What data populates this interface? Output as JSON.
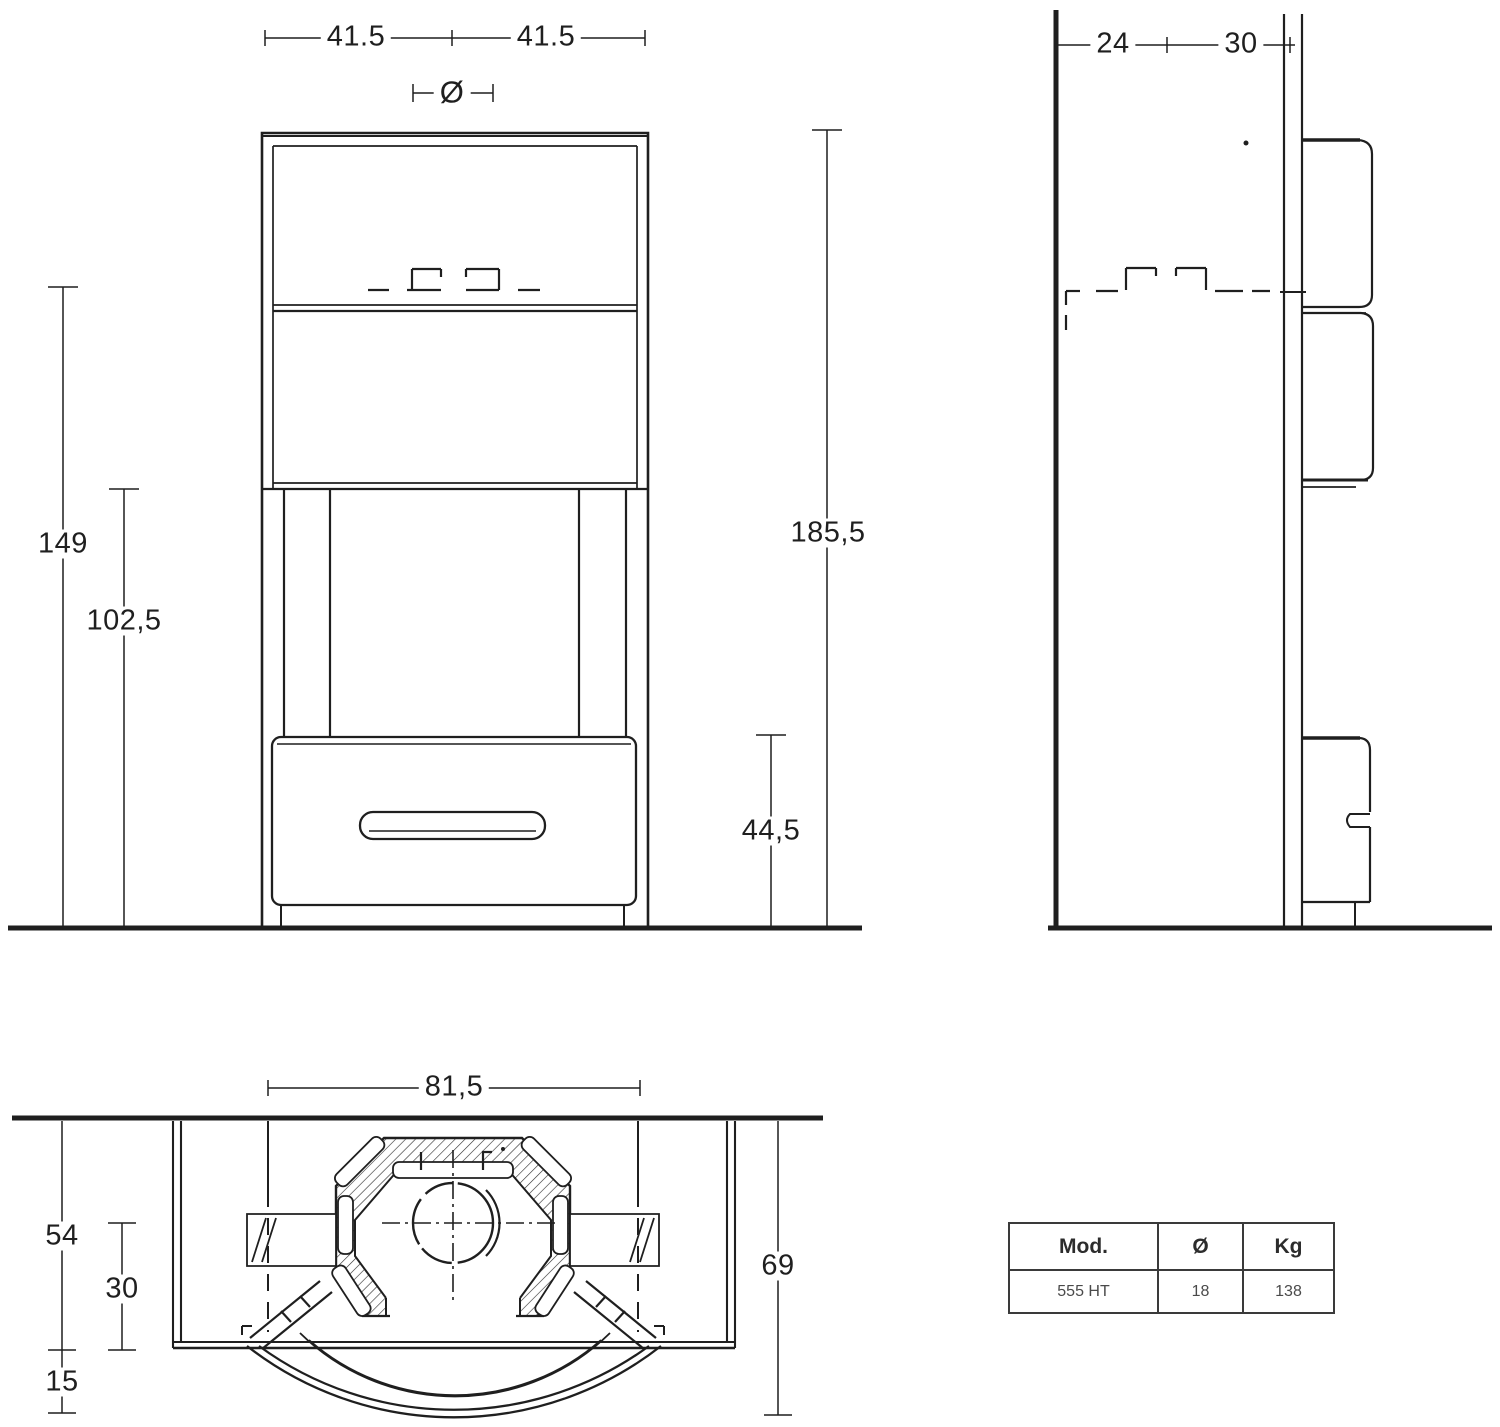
{
  "front_view": {
    "dim_half_width_left": "41.5",
    "dim_half_width_right": "41.5",
    "flue_diameter_symbol": "Ø",
    "dim_flue_rear_height": "149",
    "dim_outlet_height": "102,5",
    "dim_total_height": "185,5",
    "dim_firebox_floor_height": "44,5"
  },
  "side_view": {
    "dim_wall_to_flue_axis": "24",
    "dim_flue_axis_to_front": "30"
  },
  "plan_view": {
    "dim_overall_width": "81,5",
    "dim_wall_to_panel_front": "54",
    "dim_flue_axis_to_panel_front": "30",
    "dim_door_projection": "15",
    "dim_wall_to_door_front": "69"
  },
  "spec_table": {
    "col_mod": "Mod.",
    "col_diameter": "Ø",
    "col_weight": "Kg",
    "row_model": "555 HT",
    "row_diameter": "18",
    "row_weight": "138"
  }
}
